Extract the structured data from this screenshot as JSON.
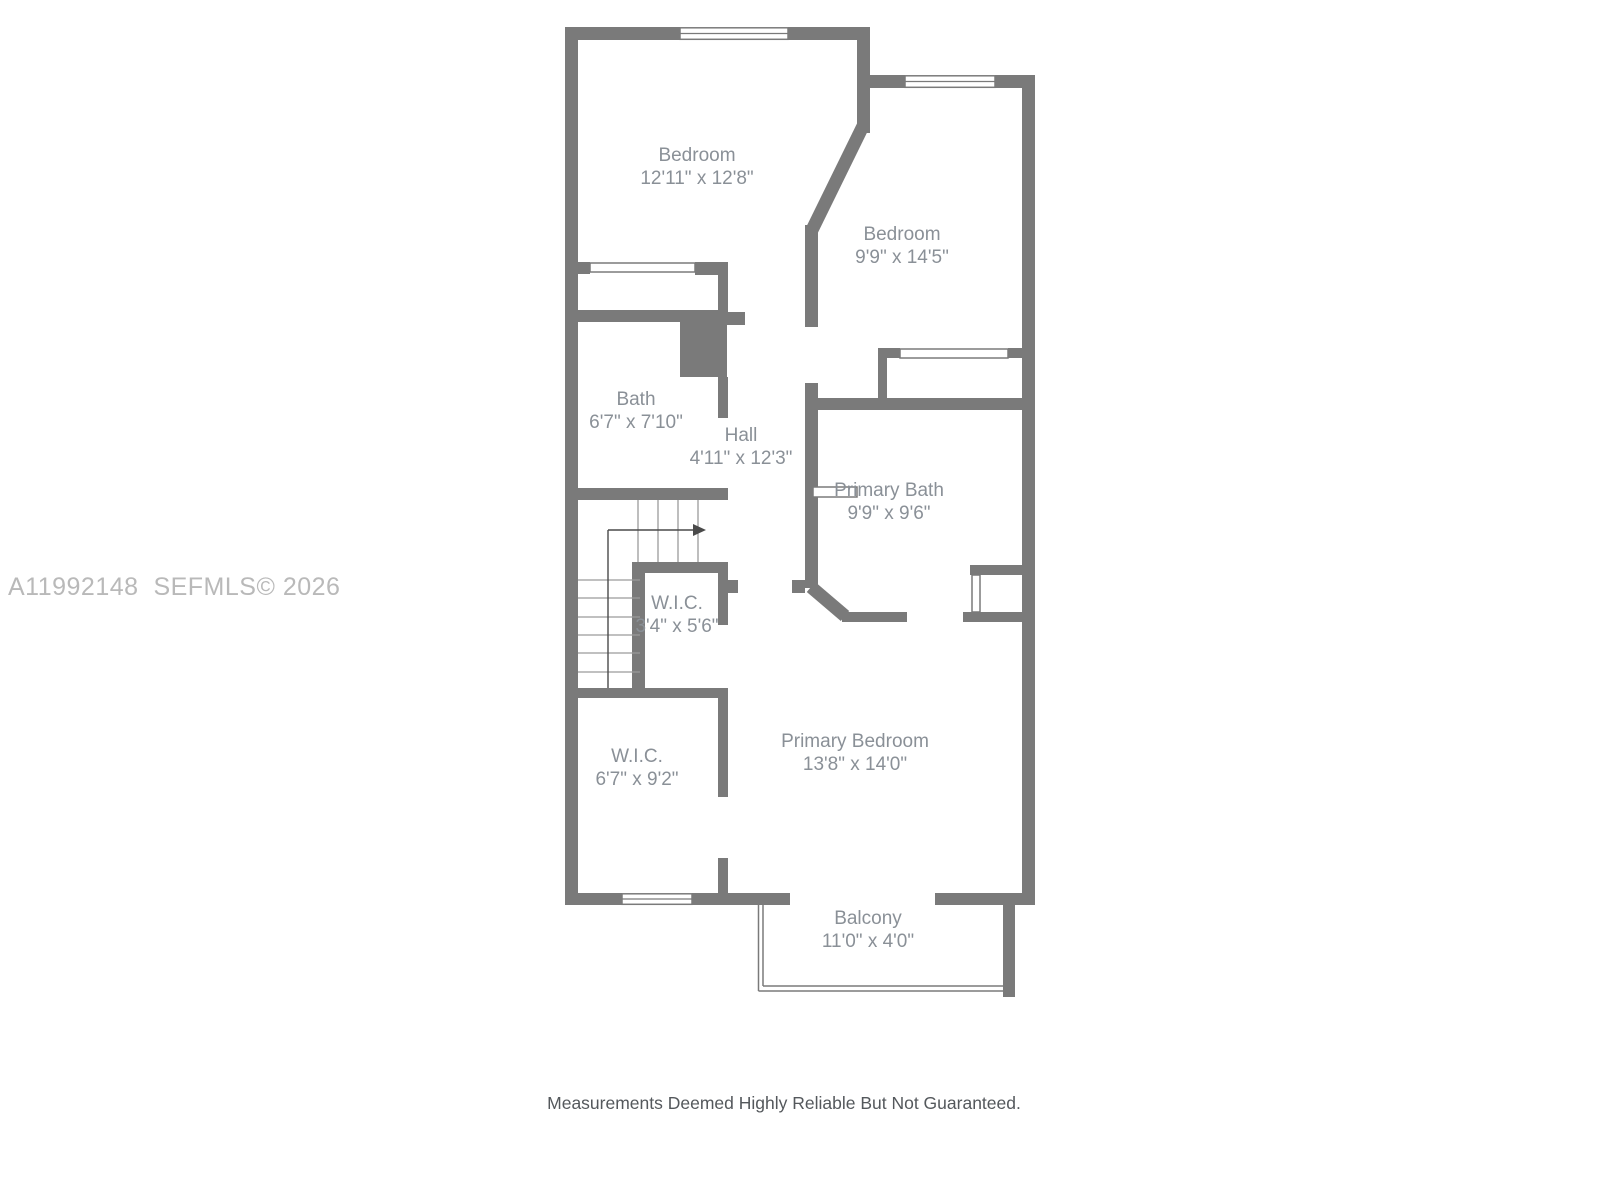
{
  "watermark": "A11992148  SEFMLS© 2026",
  "footer": "Measurements Deemed Highly Reliable But Not Guaranteed.",
  "rooms": [
    {
      "name": "Bedroom",
      "dims": "12'11\" x 12'8\""
    },
    {
      "name": "Bedroom",
      "dims": "9'9\" x 14'5\""
    },
    {
      "name": "Bath",
      "dims": "6'7\" x 7'10\""
    },
    {
      "name": "Hall",
      "dims": "4'11\" x 12'3\""
    },
    {
      "name": "Primary Bath",
      "dims": "9'9\" x 9'6\""
    },
    {
      "name": "W.I.C.",
      "dims": "3'4\" x 5'6\""
    },
    {
      "name": "W.I.C.",
      "dims": "6'7\" x 9'2\""
    },
    {
      "name": "Primary Bedroom",
      "dims": "13'8\" x 14'0\""
    },
    {
      "name": "Balcony",
      "dims": "11'0\" x 4'0\""
    }
  ],
  "colors": {
    "wall": "#7a7a7a",
    "label": "#8a9097",
    "watermark": "#b9b9b9",
    "footer": "#54585c",
    "tread": "#9a9a9a",
    "arrow": "#4a4a4a"
  }
}
